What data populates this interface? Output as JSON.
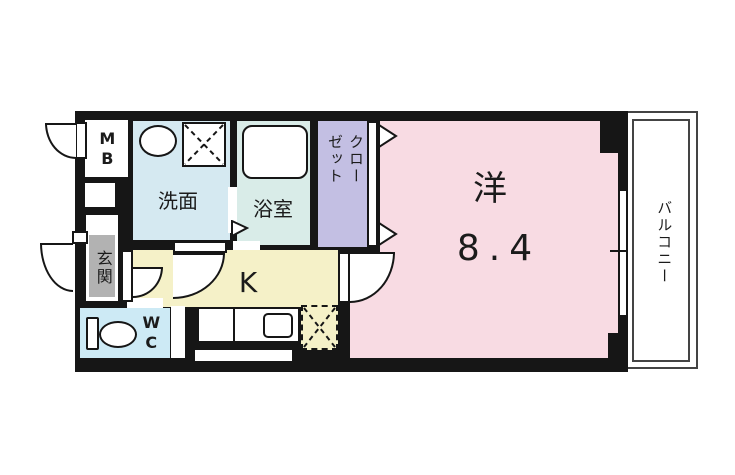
{
  "plan": {
    "type": "apartment-floor-plan-1K",
    "rooms": {
      "western": {
        "label": "洋",
        "size": "8.4"
      },
      "kitchen": {
        "label": "K"
      },
      "washroom": {
        "label": "洗面"
      },
      "bathroom": {
        "label": "浴室"
      },
      "closet": {
        "label": "クローゼット"
      },
      "entrance": {
        "label": "玄関"
      },
      "wc": {
        "label": "WC"
      },
      "meter_box": {
        "label": "MB"
      },
      "balcony": {
        "label": "バルコニー"
      }
    }
  },
  "colors": {
    "wall": "#161616",
    "western_room": "#f8dbe3",
    "kitchen": "#f5f1c8",
    "washroom": "#d5e9f1",
    "bathroom": "#d9ece8",
    "wc": "#cdeaf5",
    "closet": "#c3bfe3",
    "entrance_gray": "#b2b2b2",
    "line": "#444444"
  }
}
